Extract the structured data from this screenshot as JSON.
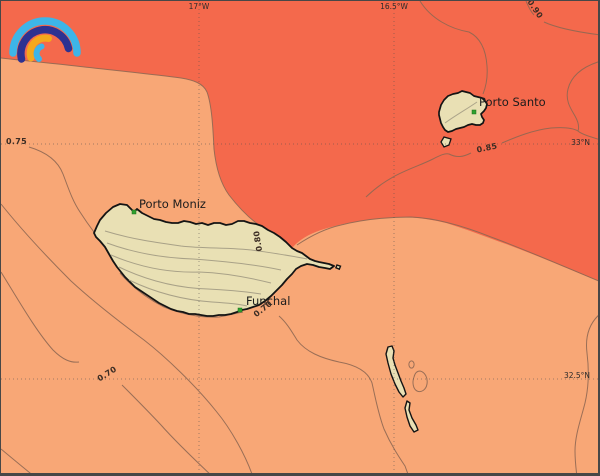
{
  "map": {
    "type": "filled-contour-map",
    "region": "Madeira archipelago",
    "places": [
      {
        "name": "Porto Moniz",
        "marker": "green-square"
      },
      {
        "name": "Funchal",
        "marker": "green-square"
      },
      {
        "name": "Porto Santo",
        "marker": "green-square"
      }
    ],
    "islands": [
      "Madeira",
      "Porto Santo",
      "Desertas"
    ],
    "grid": {
      "meridians": [
        "17°W",
        "16.5°W"
      ],
      "parallels": [
        "33°N",
        "32.5°N"
      ],
      "style": "dotted"
    },
    "contours": {
      "levels": [
        0.7,
        0.75,
        0.8,
        0.85,
        0.9
      ],
      "labels": {
        "l090": "0.90",
        "l085": "0.85",
        "l080": "0.80",
        "l075": "0.75",
        "l070a": "0.70",
        "l070b": "0.70"
      },
      "fill_bands": [
        {
          "range": "< 0.80",
          "color": "#f8a776"
        },
        {
          "range": "≥ 0.80",
          "color": "#f4694c"
        }
      ]
    },
    "colors": {
      "field_low": "#f8a776",
      "field_high": "#f4694c",
      "land": "#e9e0b4",
      "coastline": "#141414",
      "contour_line": "#8d6752",
      "land_contour": "#a59d85",
      "marker_green": "#2ea12e",
      "logo_blue": "#3db5e8",
      "logo_navy": "#2d3191",
      "logo_orange": "#f4a81d"
    },
    "logo": {
      "name": "pangeo-rainbow-logo"
    }
  }
}
